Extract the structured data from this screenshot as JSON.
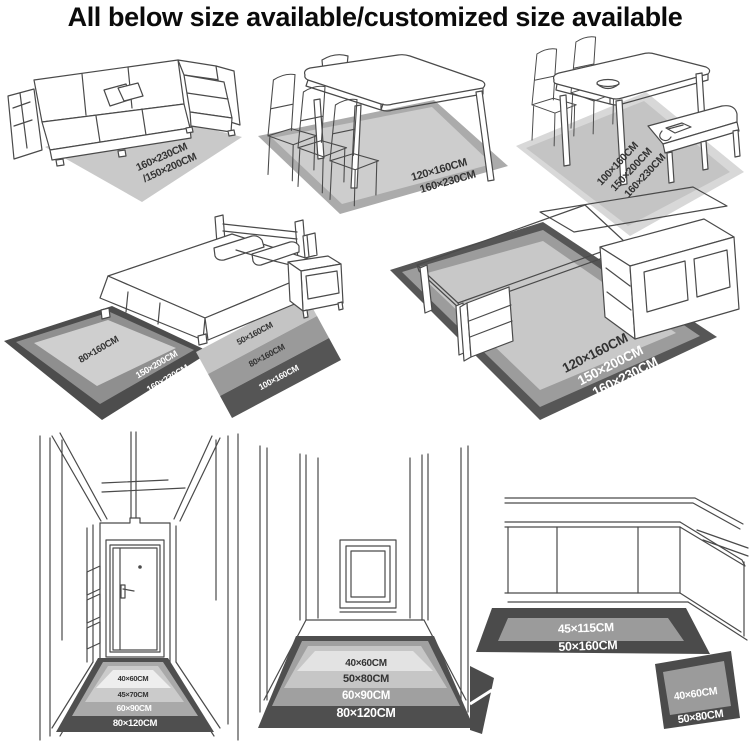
{
  "title": "All below size available/customized size available",
  "colors": {
    "line": "#4a4a4a",
    "rug_light": "#cccccc",
    "rug_medium": "#9b9b9b",
    "rug_dark": "#4f4f4f",
    "label_dark": "#333333",
    "label_light": "#ffffff"
  },
  "scenes": {
    "living_room": {
      "name": "sofa with rug",
      "rug_labels": [
        "160×230CM",
        "/150×200CM"
      ]
    },
    "dining_room": {
      "name": "dining table with rug",
      "rug_labels": [
        "120×160CM",
        "160×230CM"
      ]
    },
    "dinette": {
      "name": "table with bench and rug",
      "rug_labels": [
        "100×160CM",
        "150×200CM",
        "160×230CM"
      ]
    },
    "bedroom": {
      "name": "bed with rug and runner",
      "main_rug_labels": [
        "80×160CM",
        "150×200CM",
        "160×230CM"
      ],
      "runner_labels": [
        "50×160CM",
        "80×160CM",
        "100×160CM"
      ]
    },
    "study": {
      "name": "desk with rug",
      "rug_labels": [
        "120×160CM",
        "150×200CM",
        "160×230CM"
      ]
    },
    "hallway_door": {
      "name": "entry hallway with door mat",
      "rug_labels": [
        "40×60CM",
        "45×70CM",
        "60×90CM",
        "80×120CM"
      ]
    },
    "hallway": {
      "name": "hallway with mat",
      "rug_labels": [
        "40×60CM",
        "50×80CM",
        "60×90CM",
        "80×120CM"
      ]
    },
    "kitchen": {
      "name": "kitchen with runner and mat",
      "runner_labels": [
        "45×115CM",
        "50×160CM"
      ],
      "mat_labels": [
        "40×60CM",
        "50×80CM"
      ]
    }
  }
}
